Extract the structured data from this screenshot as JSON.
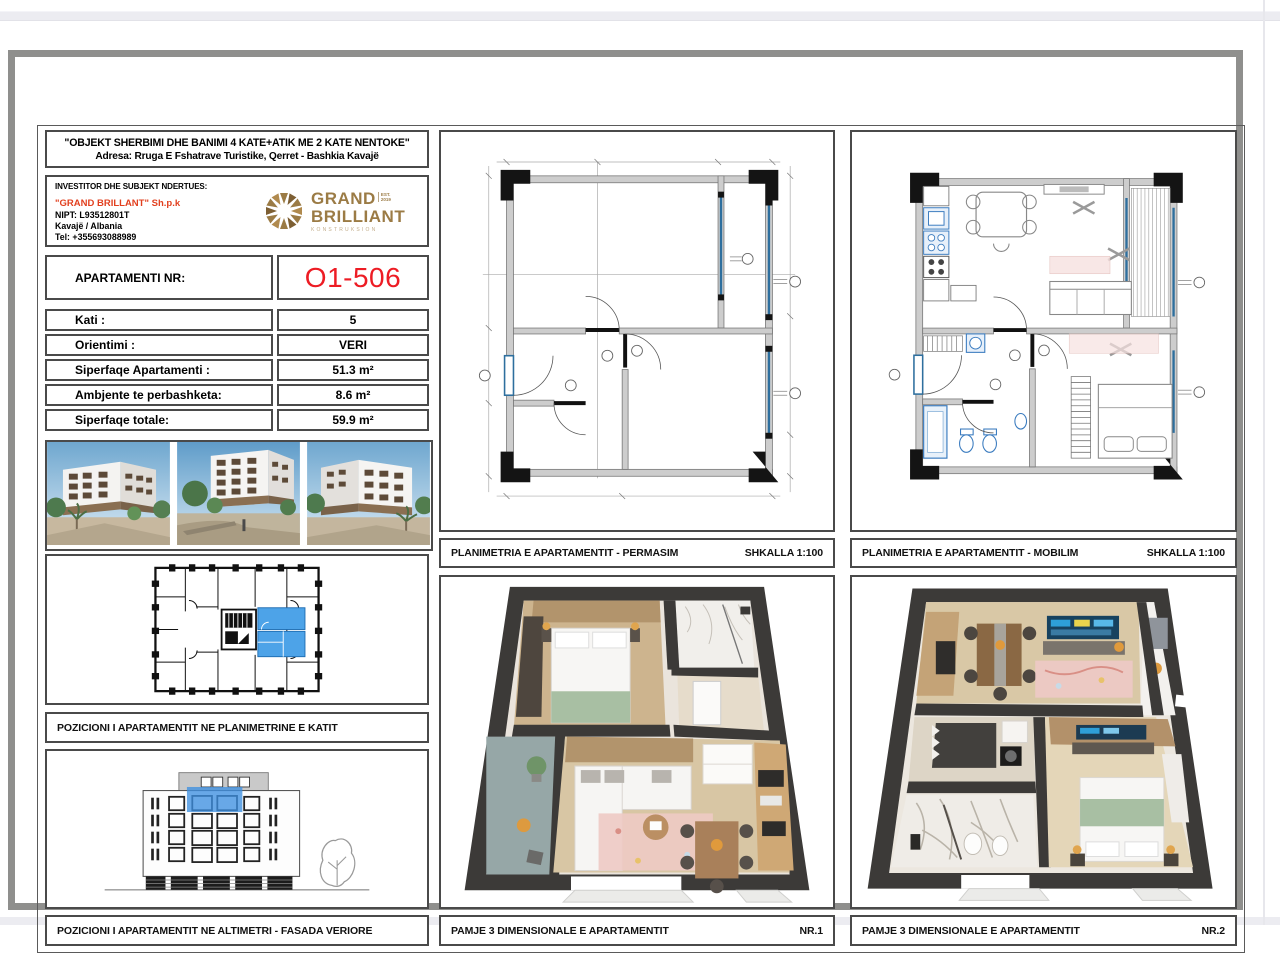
{
  "header": {
    "title": "\"OBJEKT SHERBIMI DHE BANIMI 4 KATE+ATIK ME 2 KATE NENTOKE\"",
    "address": "Adresa: Rruga E Fshatrave Turistike, Qerret - Bashkia Kavajë"
  },
  "investor": {
    "heading": "INVESTITOR DHE SUBJEKT NDERTUES:",
    "company": "\"GRAND BRILLANT\" Sh.p.k",
    "nipt": "NIPT: L93512801T",
    "location": "Kavajë / Albania",
    "tel": "Tel: +355693088989",
    "company_color": "#e2401f",
    "logo": {
      "line1": "GRAND",
      "line2": "BRILLIANT",
      "est": "EST.",
      "year": "2019",
      "sub": "KONSTRUKSION",
      "color": "#9b7b45"
    }
  },
  "apartment": {
    "label": "APARTAMENTI NR:",
    "number": "O1-506",
    "number_color": "#ed1c24"
  },
  "details": {
    "rows": [
      {
        "label": "Kati :",
        "value": "5"
      },
      {
        "label": "Orientimi :",
        "value": "VERI"
      },
      {
        "label": "Siperfaqe Apartamenti :",
        "value": "51.3 m²"
      },
      {
        "label": "Ambjente te perbashketa:",
        "value": "8.6 m²"
      },
      {
        "label": "Siperfaqe totale:",
        "value": "59.9 m²"
      }
    ]
  },
  "panels": {
    "plan_permasim": {
      "title": "PLANIMETRIA E APARTAMENTIT - PERMASIM",
      "scale": "SHKALLA 1:100"
    },
    "plan_mobilim": {
      "title": "PLANIMETRIA E APARTAMENTIT - MOBILIM",
      "scale": "SHKALLA 1:100"
    },
    "key_plan_label": "POZICIONI I APARTAMENTIT NE PLANIMETRINE E KATIT",
    "elevation_label": "POZICIONI I APARTAMENTIT NE ALTIMETRI - FASADA VERIORE",
    "view1": {
      "title": "PAMJE 3 DIMENSIONALE E APARTAMENTIT",
      "nr": "NR.1"
    },
    "view2": {
      "title": "PAMJE 3 DIMENSIONALE E APARTAMENTIT",
      "nr": "NR.2"
    }
  },
  "highlight_color": "#3d8fe0"
}
